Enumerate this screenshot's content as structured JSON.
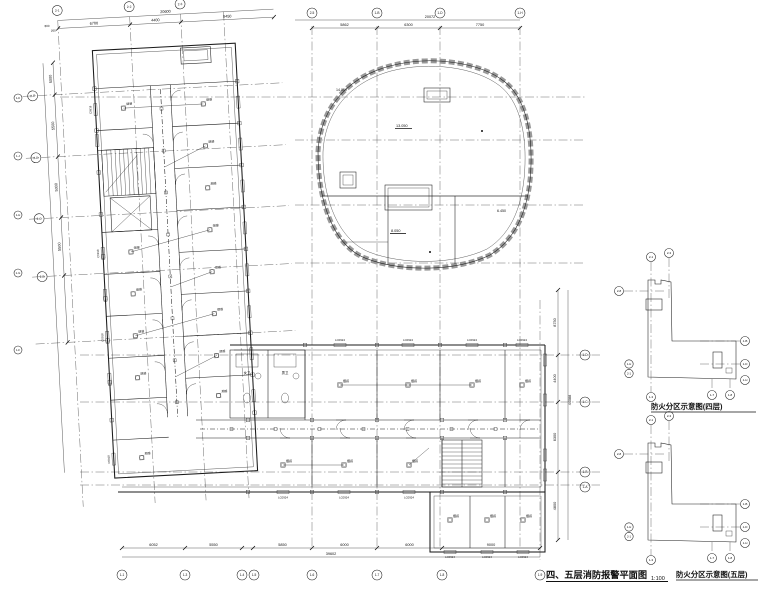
{
  "sheet": {
    "title": "四、五层消防报警平面图",
    "scale": "1:100"
  },
  "fire_diagrams": {
    "four": {
      "title": "防火分区示意图(四层)"
    },
    "five": {
      "title": "防火分区示意图(五层)"
    },
    "bubbles": {
      "top": [
        "2-1",
        "2-3"
      ],
      "left": "2-8",
      "left_pair": [
        "1-H",
        "2-1"
      ],
      "bottom": [
        "1-3",
        "1-7",
        "1-8"
      ],
      "right": [
        "1-B",
        "1-D",
        "1-H"
      ]
    }
  },
  "dimensions": {
    "top_left": {
      "overall": "20600",
      "segments": [
        "6700",
        "4400",
        "8450"
      ],
      "start": [
        "800",
        "250"
      ]
    },
    "top_right": {
      "overall": "20072",
      "segments": [
        "5862",
        "6300",
        "7750"
      ]
    },
    "bottom": {
      "overall": "39602",
      "segments": [
        "6052",
        "5550",
        "5850",
        "6000",
        "6000",
        "9000"
      ]
    },
    "left": {
      "segments": [
        "5000",
        "5500",
        "5000",
        "5500"
      ]
    },
    "right": {
      "overall": "44088",
      "segments": [
        "8750",
        "4400",
        "6300",
        "4800"
      ]
    }
  },
  "grid": {
    "top_bubbles": [
      "2-1",
      "2-2",
      "2-3",
      "2-5",
      "1-B",
      "1-D",
      "1-H"
    ],
    "bottom_bubbles": [
      "1-1",
      "1-3",
      "1-4",
      "1-5",
      "1-6",
      "1-7",
      "1-8",
      "1-9"
    ],
    "left_bubbles": [
      "2-E",
      "2-D",
      "2-C",
      "2-B"
    ],
    "edge_bubbles": [
      "1-K",
      "1-J",
      "1-H",
      "1-G",
      "1-F"
    ],
    "right_bubbles": [
      "1-D",
      "1-C",
      "1-B",
      "1-A"
    ]
  },
  "annotations": {
    "detector": "烟感",
    "window_top": "LC0924",
    "window_bottom": "LC0924",
    "window_side": "C0918",
    "room_wc_female": "女卫",
    "room_wc_male": "男卫",
    "elevations": {
      "edge": "14.050",
      "upper": "13.050",
      "lower": "8.050",
      "right": "6.450"
    }
  }
}
